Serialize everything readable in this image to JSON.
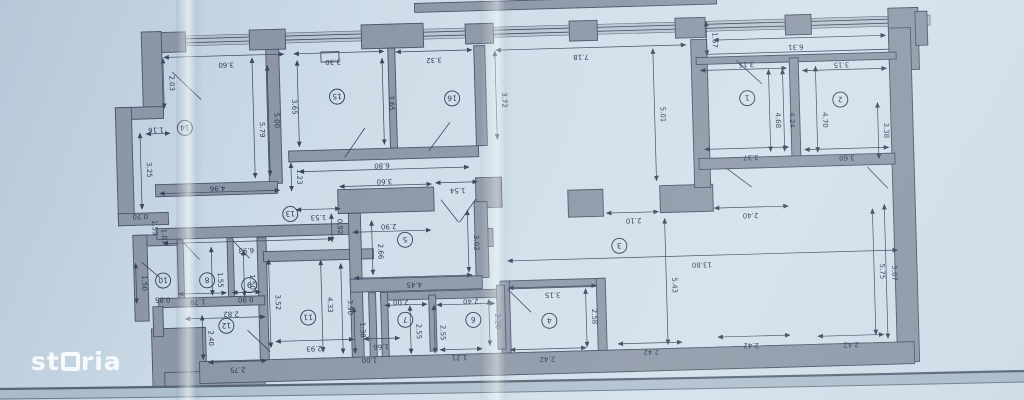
{
  "watermark": {
    "text": "storia"
  },
  "palette": {
    "paper": "#cddce8",
    "wall": "#8d97a6",
    "wall_outline": "#47526a",
    "ink": "#2c3850",
    "window": "#b9c5d1",
    "edge_band": "#aebfcd"
  },
  "plan": {
    "rotation": -1.6,
    "note": "floor plan photographed upside down; all labels rotated 180deg",
    "rooms": [
      [
        "14",
        187,
        118
      ],
      [
        "15",
        340,
        91
      ],
      [
        "16",
        455,
        96
      ],
      [
        "1",
        750,
        104
      ],
      [
        "2",
        843,
        108
      ],
      [
        "13",
        290,
        207
      ],
      [
        "5",
        404,
        236
      ],
      [
        "3",
        618,
        248
      ],
      [
        "8",
        205,
        271
      ],
      [
        "9",
        247,
        277
      ],
      [
        "10",
        161,
        270
      ],
      [
        "12",
        223,
        317
      ],
      [
        "11",
        305,
        311
      ],
      [
        "7",
        402,
        316
      ],
      [
        "6",
        470,
        318
      ],
      [
        "4",
        546,
        321
      ]
    ],
    "walls": [
      [
        420,
        0,
        302,
        9
      ],
      [
        152,
        22,
        38,
        20
      ],
      [
        254,
        22,
        36,
        20
      ],
      [
        366,
        20,
        62,
        24
      ],
      [
        470,
        22,
        28,
        20
      ],
      [
        574,
        22,
        28,
        20
      ],
      [
        680,
        22,
        30,
        20
      ],
      [
        790,
        22,
        26,
        20
      ],
      [
        893,
        18,
        30,
        62
      ],
      [
        920,
        22,
        12,
        34
      ],
      [
        893,
        38,
        22,
        334
      ],
      [
        146,
        21,
        20,
        86
      ],
      [
        118,
        96,
        48,
        12
      ],
      [
        118,
        96,
        16,
        118
      ],
      [
        118,
        202,
        50,
        12
      ],
      [
        132,
        224,
        48,
        11
      ],
      [
        132,
        224,
        14,
        86
      ],
      [
        148,
        318,
        54,
        60
      ],
      [
        160,
        362,
        100,
        22
      ],
      [
        195,
        352,
        715,
        22
      ],
      [
        270,
        42,
        13,
        134
      ],
      [
        392,
        44,
        7,
        100
      ],
      [
        478,
        44,
        11,
        100
      ],
      [
        476,
        176,
        26,
        30
      ],
      [
        477,
        227,
        15,
        18
      ],
      [
        156,
        174,
        122,
        12
      ],
      [
        290,
        144,
        190,
        11
      ],
      [
        338,
        184,
        96,
        24
      ],
      [
        156,
        218,
        196,
        11
      ],
      [
        176,
        230,
        6,
        60
      ],
      [
        226,
        230,
        6,
        60
      ],
      [
        256,
        230,
        9,
        122
      ],
      [
        156,
        288,
        106,
        9
      ],
      [
        150,
        296,
        10,
        30
      ],
      [
        262,
        244,
        110,
        10
      ],
      [
        348,
        208,
        12,
        144
      ],
      [
        474,
        200,
        13,
        76
      ],
      [
        348,
        274,
        132,
        13
      ],
      [
        568,
        191,
        35,
        27
      ],
      [
        660,
        189,
        53,
        27
      ],
      [
        695,
        44,
        16,
        148
      ],
      [
        700,
        62,
        200,
        7
      ],
      [
        793,
        65,
        9,
        102
      ],
      [
        700,
        163,
        196,
        11
      ],
      [
        498,
        280,
        104,
        8
      ],
      [
        498,
        280,
        9,
        72
      ],
      [
        594,
        280,
        9,
        72
      ],
      [
        378,
        288,
        122,
        8
      ],
      [
        378,
        288,
        7,
        64
      ],
      [
        426,
        292,
        7,
        56
      ],
      [
        494,
        284,
        8,
        64
      ],
      [
        366,
        288,
        7,
        64
      ]
    ],
    "windows": [
      [
        158,
        26,
        777,
        10
      ],
      [
        120,
        120,
        10,
        70
      ],
      [
        205,
        352,
        52,
        9
      ],
      [
        300,
        352,
        52,
        9
      ],
      [
        368,
        352,
        32,
        9
      ],
      [
        437,
        352,
        43,
        9
      ],
      [
        505,
        352,
        78,
        9
      ],
      [
        612,
        352,
        68,
        9
      ],
      [
        712,
        352,
        76,
        9
      ],
      [
        812,
        352,
        68,
        9
      ]
    ],
    "lines": [
      [
        160,
        29,
        893,
        29
      ],
      [
        160,
        33,
        893,
        33
      ],
      [
        700,
        59,
        893,
        59
      ],
      [
        205,
        356,
        257,
        356
      ],
      [
        300,
        356,
        352,
        356
      ],
      [
        368,
        356,
        400,
        356
      ],
      [
        437,
        356,
        480,
        356
      ],
      [
        505,
        356,
        583,
        356
      ],
      [
        612,
        356,
        680,
        356
      ],
      [
        712,
        356,
        788,
        356
      ],
      [
        812,
        356,
        880,
        356
      ]
    ],
    "outlines": [
      [
        325,
        46,
        18,
        10
      ]
    ],
    "doors": [
      [
        176,
        62,
        204,
        90
      ],
      [
        346,
        152,
        367,
        123
      ],
      [
        430,
        148,
        452,
        120
      ],
      [
        740,
        66,
        765,
        90
      ],
      [
        728,
        174,
        752,
        193
      ],
      [
        868,
        176,
        888,
        198
      ],
      [
        505,
        288,
        528,
        312
      ],
      [
        441,
        197,
        458,
        220
      ],
      [
        459,
        220,
        476,
        197
      ],
      [
        182,
        232,
        198,
        250
      ],
      [
        232,
        232,
        248,
        250
      ],
      [
        140,
        251,
        158,
        267
      ],
      [
        244,
        322,
        266,
        344
      ]
    ],
    "dims": [
      [
        "3.60",
        230,
        54,
        0,
        [
          168,
          47,
          288,
          47
        ]
      ],
      [
        "3.30",
        337,
        54,
        0,
        [
          298,
          47,
          388,
          47
        ]
      ],
      [
        "3.32",
        438,
        55,
        0,
        [
          400,
          48,
          476,
          48
        ]
      ],
      [
        "7.18",
        585,
        56,
        0,
        [
          500,
          49,
          690,
          49
        ]
      ],
      [
        "6.31",
        800,
        52,
        0,
        [
          718,
          45,
          890,
          45
        ]
      ],
      [
        "3.15",
        750,
        68,
        0,
        [
          704,
          75,
          790,
          75
        ]
      ],
      [
        "3.15",
        845,
        71,
        0,
        [
          806,
          78,
          890,
          78
        ]
      ],
      [
        "3.37",
        752,
        161,
        0,
        [
          706,
          154,
          790,
          154
        ]
      ],
      [
        "3.60",
        848,
        164,
        0,
        [
          806,
          157,
          890,
          157
        ]
      ],
      [
        "6.80",
        383,
        159,
        0,
        [
          300,
          165,
          470,
          165
        ]
      ],
      [
        "3.60",
        385,
        175,
        0,
        [
          340,
          181,
          432,
          181
        ]
      ],
      [
        "4.96",
        218,
        177,
        0,
        [
          160,
          183,
          280,
          183
        ]
      ],
      [
        "1.53",
        318,
        209,
        0,
        [
          296,
          203,
          340,
          203
        ]
      ],
      [
        "1.54",
        458,
        186,
        0,
        [
          436,
          180,
          478,
          180
        ]
      ],
      [
        "6.93",
        245,
        240,
        0,
        [
          162,
          233,
          332,
          233
        ]
      ],
      [
        "2.90",
        388,
        220,
        0,
        [
          352,
          227,
          430,
          227
        ]
      ],
      [
        "4.45",
        412,
        279,
        0,
        [
          352,
          273,
          470,
          273
        ]
      ],
      [
        "2.10",
        633,
        221,
        0,
        [
          606,
          215,
          658,
          215
        ]
      ],
      [
        "2.40",
        750,
        219,
        0,
        [
          714,
          213,
          788,
          213
        ]
      ],
      [
        "13.80",
        700,
        267,
        0,
        [
          506,
          260,
          896,
          260
        ]
      ],
      [
        "3.15",
        550,
        293,
        0,
        [
          506,
          287,
          594,
          287
        ]
      ],
      [
        "2.42",
        543,
        357,
        0,
        [
          506,
          349,
          582,
          349
        ]
      ],
      [
        "2.42",
        647,
        353,
        0,
        [
          614,
          346,
          678,
          346
        ]
      ],
      [
        "2.42",
        747,
        349,
        0,
        [
          714,
          342,
          786,
          342
        ]
      ],
      [
        "2.42",
        847,
        351,
        0,
        [
          814,
          344,
          880,
          344
        ]
      ],
      [
        "2.93",
        310,
        340,
        0,
        [
          272,
          334,
          350,
          334
        ]
      ],
      [
        "2.75",
        233,
        359,
        0,
        [
          204,
          353,
          262,
          353
        ]
      ],
      [
        "1.78",
        195,
        290,
        0,
        [
          176,
          284,
          224,
          284
        ]
      ],
      [
        "0.85",
        160,
        287,
        0,
        null
      ],
      [
        "0.90",
        243,
        289,
        0,
        [
          230,
          284,
          258,
          284
        ]
      ],
      [
        "2.82",
        228,
        303,
        0,
        [
          182,
          309,
          262,
          309
        ]
      ],
      [
        "1.66",
        377,
        340,
        0,
        [
          360,
          334,
          396,
          334
        ]
      ],
      [
        "1.00",
        365,
        353,
        0,
        null
      ],
      [
        "2.00",
        398,
        296,
        0,
        [
          382,
          301,
          424,
          301
        ]
      ],
      [
        "2.40",
        468,
        297,
        0,
        [
          434,
          302,
          492,
          302
        ]
      ],
      [
        "1.21",
        455,
        353,
        0,
        [
          436,
          347,
          478,
          347
        ]
      ],
      [
        "0.70",
        140,
        203,
        0,
        null
      ],
      [
        "1.16",
        158,
        117,
        0,
        [
          148,
          123,
          172,
          123
        ]
      ],
      [
        "2.03",
        173,
        73,
        1,
        [
          167,
          48,
          167,
          98
        ]
      ],
      [
        "3.25",
        148,
        159,
        1,
        [
          142,
          122,
          142,
          198
        ]
      ],
      [
        "5.79",
        262,
        122,
        1,
        [
          256,
          50,
          256,
          170
        ]
      ],
      [
        "5.00",
        277,
        113,
        1,
        [
          271,
          58,
          271,
          168
        ]
      ],
      [
        "3.65",
        295,
        100,
        1,
        [
          301,
          54,
          301,
          140
        ]
      ],
      [
        "3.65",
        392,
        99,
        1,
        [
          386,
          54,
          386,
          140
        ]
      ],
      [
        "1.23",
        298,
        170,
        1,
        [
          292,
          156,
          292,
          184
        ]
      ],
      [
        "3.72",
        505,
        99,
        1,
        [
          499,
          50,
          499,
          138
        ]
      ],
      [
        "5.01",
        663,
        118,
        1,
        [
          657,
          52,
          657,
          184
        ]
      ],
      [
        "1.67",
        717,
        45,
        1,
        [
          711,
          26,
          711,
          60
        ]
      ],
      [
        "4.68",
        778,
        127,
        1,
        [
          772,
          76,
          772,
          158
        ]
      ],
      [
        "4.24",
        792,
        127,
        1,
        [
          786,
          76,
          786,
          158
        ]
      ],
      [
        "4.70",
        825,
        128,
        1,
        [
          819,
          74,
          819,
          160
        ]
      ],
      [
        "3.38",
        886,
        140,
        1,
        [
          880,
          112,
          880,
          168
        ]
      ],
      [
        "1.59",
        152,
        217,
        1,
        null
      ],
      [
        "1.07",
        161,
        226,
        1,
        null
      ],
      [
        "0.92",
        337,
        221,
        1,
        [
          331,
          208,
          331,
          236
        ]
      ],
      [
        "2.66",
        377,
        247,
        1,
        [
          371,
          216,
          371,
          270
        ]
      ],
      [
        "3.02",
        473,
        241,
        1,
        [
          467,
          208,
          467,
          270
        ]
      ],
      [
        "2.58",
        589,
        318,
        1,
        [
          583,
          290,
          583,
          348
        ]
      ],
      [
        "5.43",
        670,
        289,
        1,
        [
          664,
          222,
          664,
          348
        ]
      ],
      [
        "5.75",
        878,
        281,
        1,
        [
          872,
          218,
          872,
          344
        ]
      ],
      [
        "5.07",
        890,
        283,
        1,
        [
          884,
          214,
          884,
          348
        ]
      ],
      [
        "1.50",
        140,
        272,
        1,
        [
          134,
          252,
          134,
          292
        ]
      ],
      [
        "1.55",
        216,
        271,
        1,
        [
          210,
          238,
          210,
          286
        ]
      ],
      [
        "1.50",
        248,
        274,
        1,
        [
          242,
          242,
          242,
          288
        ]
      ],
      [
        "2.40",
        205,
        329,
        1,
        [
          199,
          306,
          199,
          350
        ]
      ],
      [
        "3.52",
        273,
        295,
        1,
        [
          267,
          252,
          267,
          340
        ]
      ],
      [
        "4.33",
        325,
        299,
        1,
        [
          319,
          254,
          319,
          346
        ]
      ],
      [
        "3.90",
        345,
        302,
        1,
        [
          339,
          258,
          339,
          348
        ]
      ],
      [
        "1.38",
        357,
        325,
        1,
        [
          351,
          302,
          351,
          348
        ]
      ],
      [
        "2.55",
        413,
        328,
        1,
        [
          407,
          302,
          407,
          350
        ]
      ],
      [
        "2.55",
        437,
        330,
        1,
        [
          431,
          302,
          431,
          350
        ]
      ],
      [
        "2.20",
        492,
        320,
        1,
        [
          486,
          298,
          486,
          344
        ]
      ]
    ],
    "paper_edge": {
      "line1": [
        0,
        389,
        490,
        383,
        1024,
        371
      ],
      "line2": [
        0,
        399,
        490,
        394,
        1024,
        382
      ]
    }
  }
}
